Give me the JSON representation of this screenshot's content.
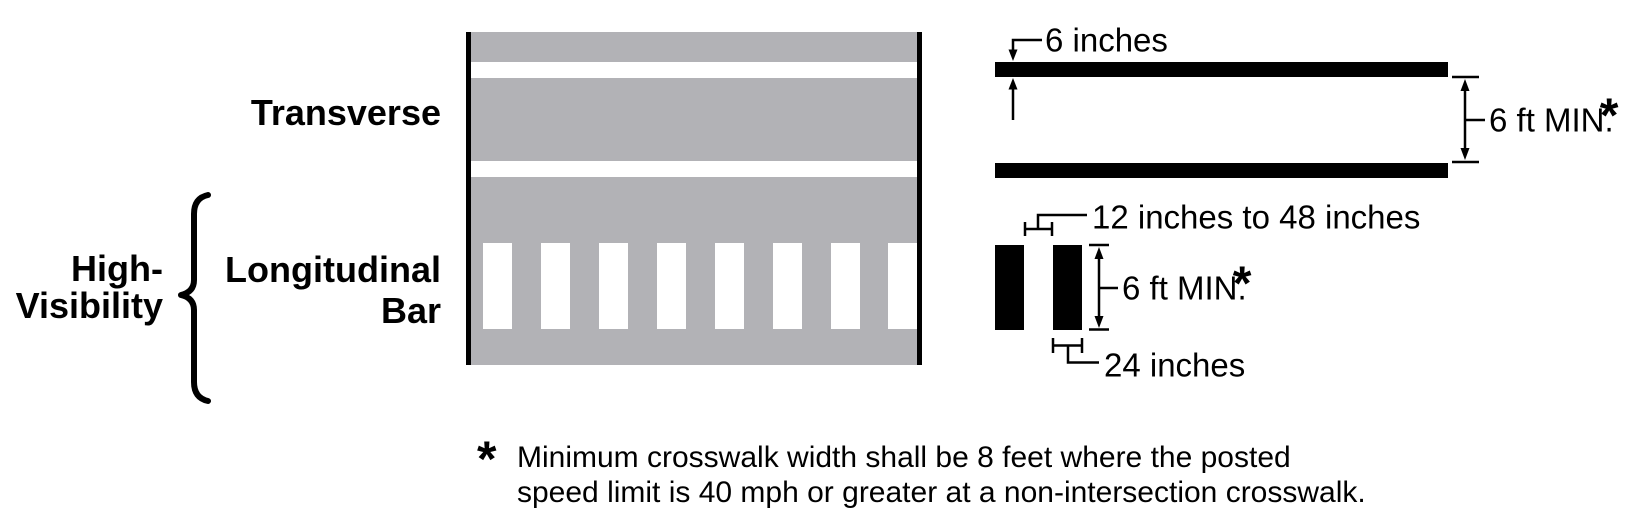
{
  "figure": {
    "labels": {
      "transverse": "Transverse",
      "high_visibility_line1": "High-",
      "high_visibility_line2": "Visibility",
      "longitudinal_line1": "Longitudinal",
      "longitudinal_line2": "Bar"
    },
    "dimensions": {
      "line_width": "6 inches",
      "transverse_spacing": "6 ft MIN.",
      "transverse_spacing_marker": "*",
      "bar_gap_range": "12 inches to 48 inches",
      "bar_length": "6 ft MIN.",
      "bar_length_marker": "*",
      "bar_pitch": "24 inches"
    },
    "footnote": {
      "marker": "*",
      "line1": "Minimum crosswalk width shall be 8 feet where the posted",
      "line2": "speed limit is 40 mph or greater at a non-intersection crosswalk."
    },
    "colors": {
      "ink": "#000000",
      "road_gray": "#b2b2b6",
      "marking_white": "#ffffff"
    }
  }
}
